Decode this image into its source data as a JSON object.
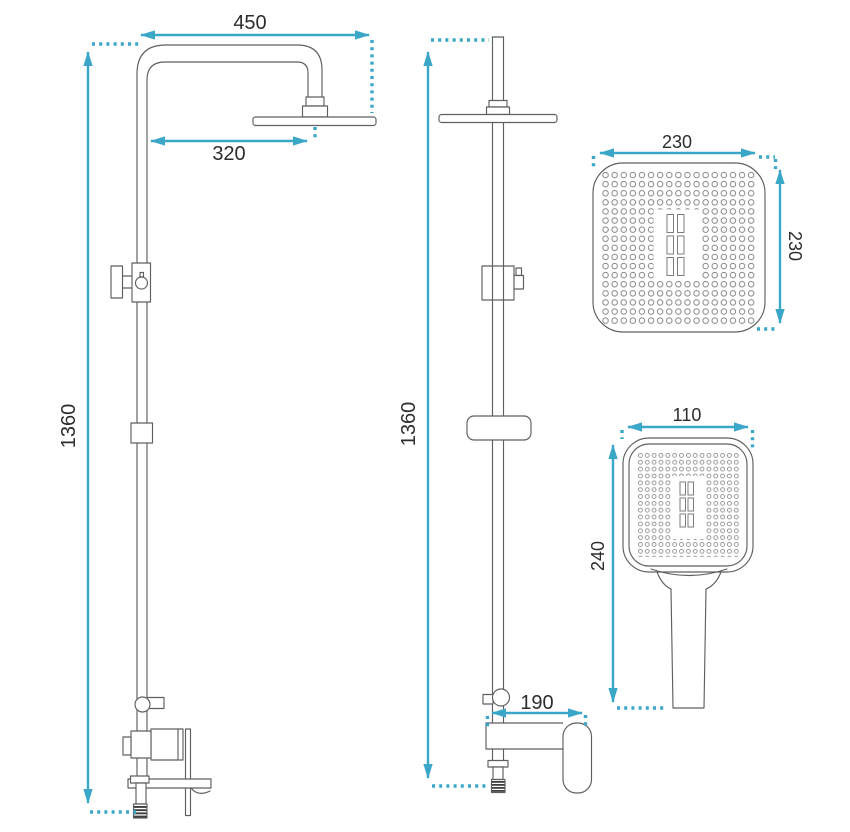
{
  "page": {
    "background": "#ffffff"
  },
  "drawing": {
    "kind": "technical dimension drawing",
    "subject": "rain shower column set with mixer and hand shower",
    "colors": {
      "dimension_line": "#3aa7c8",
      "drawing_outline": "#5d5f61",
      "label_text": "#2d2d2d"
    },
    "views": {
      "front": {
        "name": "front view",
        "dim_total_height": "1360",
        "dim_arm_width": "450",
        "dim_head_reach": "320"
      },
      "side": {
        "name": "side view",
        "dim_total_height": "1360",
        "dim_spout_reach": "190"
      },
      "head_face": {
        "name": "overhead shower face view",
        "dim_width": "230",
        "dim_depth": "230"
      },
      "hand_shower": {
        "name": "hand shower view",
        "dim_head_width": "110",
        "dim_length": "240"
      }
    }
  }
}
